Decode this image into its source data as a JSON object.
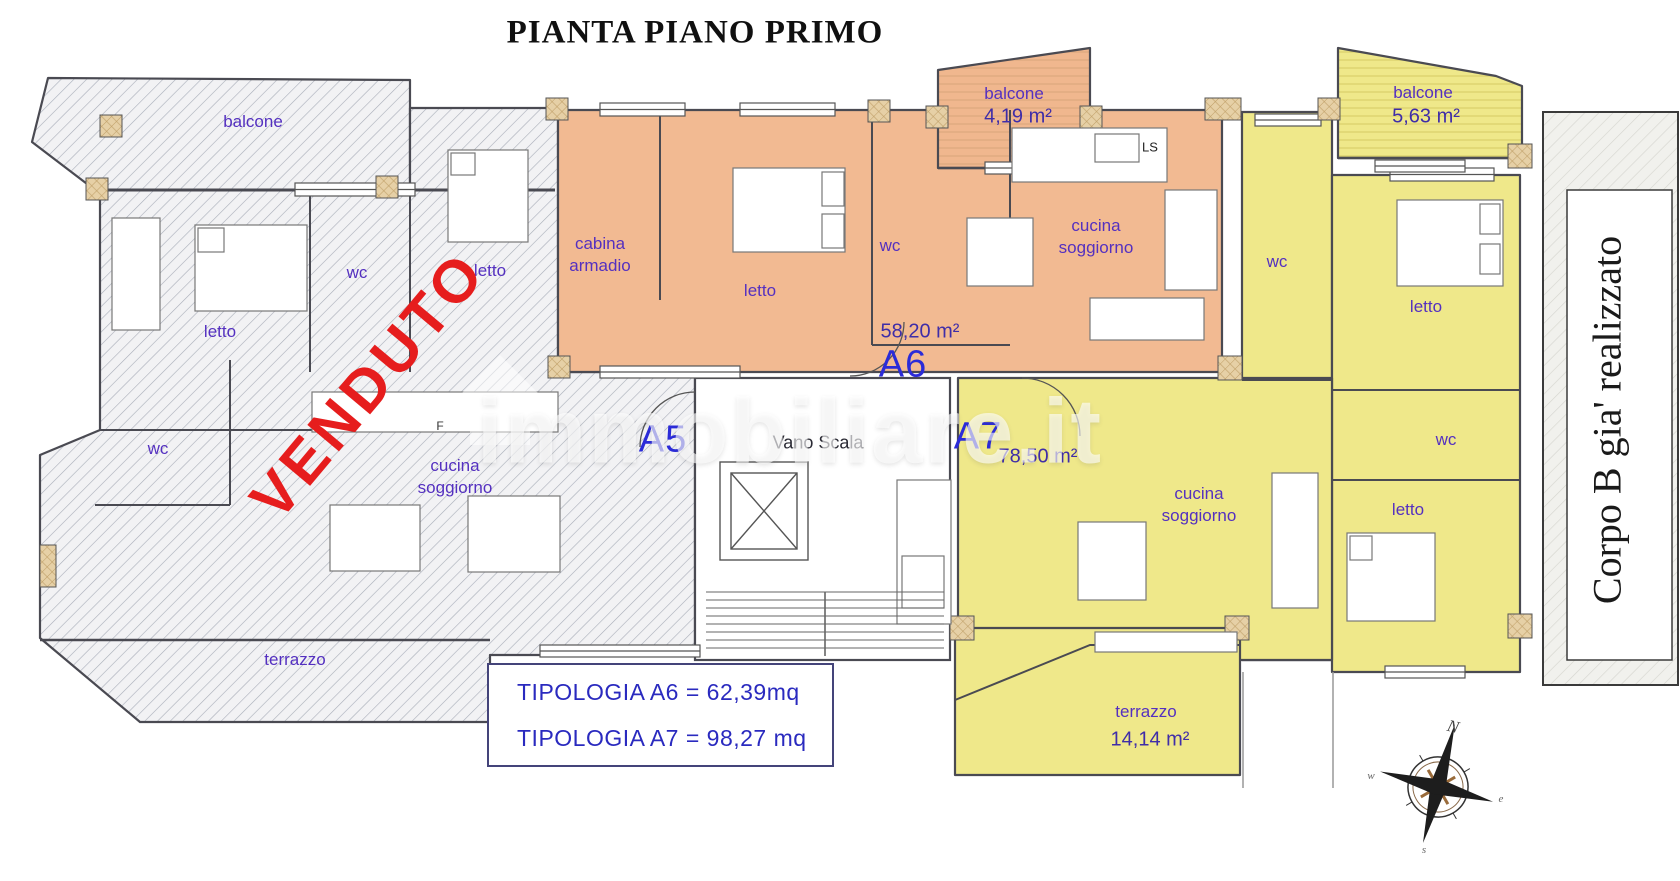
{
  "title": "PIANTA PIANO PRIMO",
  "watermark": "immobiliare.it",
  "stairwell": {
    "label": "Vano Scala"
  },
  "corpo_b": {
    "label": "Corpo B gia' realizzato"
  },
  "legend": {
    "line1": "TIPOLOGIA A6 =  62,39mq",
    "line2": "TIPOLOGIA A7 =  98,27 mq"
  },
  "compass": {
    "north": "N",
    "west": "w",
    "east": "e",
    "south": "s"
  },
  "units": {
    "a5": {
      "code": "A5",
      "status": "VENDUTO",
      "balcone": "balcone",
      "letto1": "letto",
      "wc1": "wc",
      "letto2": "letto",
      "wc2": "wc",
      "cucina": "cucina soggiorno",
      "fridge": "F",
      "terrazzo": "terrazzo"
    },
    "a6": {
      "code": "A6",
      "area": "58,20 m²",
      "balcone": "balcone",
      "balcone_area": "4,19 m²",
      "cabina": "cabina armadio",
      "letto": "letto",
      "wc": "wc",
      "cucina": "cucina soggiorno",
      "ls": "LS"
    },
    "a7": {
      "code": "A7",
      "area": "78,50 m²",
      "balcone": "balcone",
      "balcone_area": "5,63 m²",
      "wc1": "wc",
      "letto1": "letto",
      "wc2": "wc",
      "letto2": "letto",
      "cucina": "cucina soggiorno",
      "terrazzo": "terrazzo",
      "terrazzo_area": "14,14 m²"
    }
  },
  "colors": {
    "a6_fill": "#f2ba92",
    "a7_fill": "#efe88a",
    "a5_hatch": "#a8adb8",
    "wall": "#4a4a52",
    "pillar": "#e6d0a6",
    "label_purple": "#5430c0",
    "label_navy": "#3f2da8",
    "code_blue": "#2b2bd8",
    "venduto_red": "#e61d1d",
    "legend_blue": "#2a2abf"
  }
}
